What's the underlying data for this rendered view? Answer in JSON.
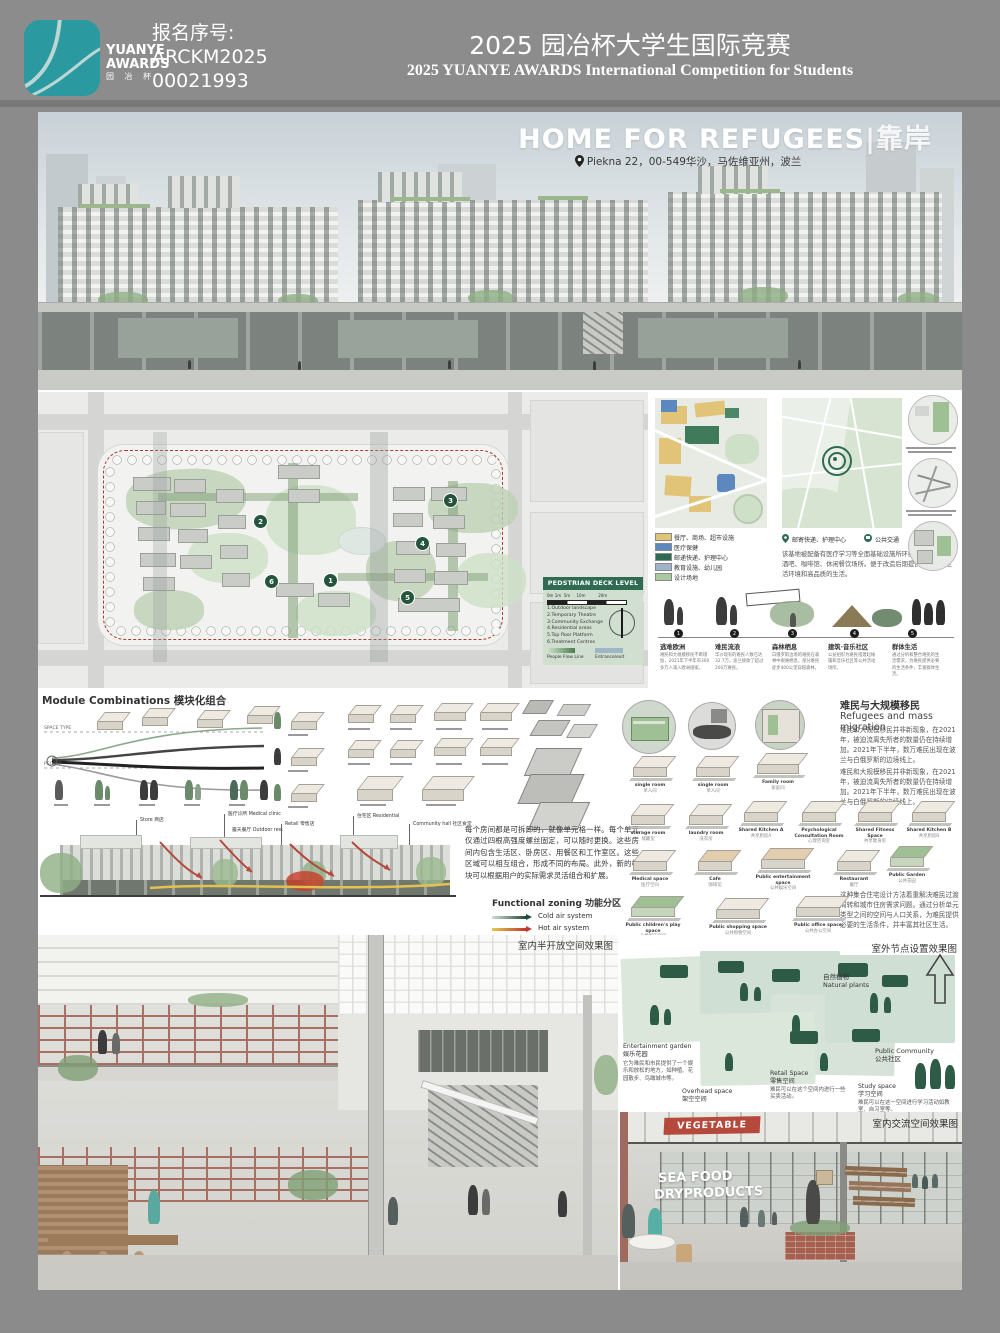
{
  "colors": {
    "brand_teal": "#2a9aa0",
    "header_gray": "#8c8c8c",
    "dark_green": "#2e6b52",
    "accent_red": "#b5493b",
    "legend1_colors": [
      "#e2c478",
      "#5d87bf",
      "#2e6b52",
      "#9fb4cc",
      "#a9c9a0"
    ]
  },
  "header": {
    "logo_line1": "YUANYE",
    "logo_line2": "AWARDS",
    "logo_line3": "园 冶 杯",
    "reg_label": "报名序号:",
    "reg_number1": "ARCKM2025",
    "reg_number2": "00021993",
    "title_zh": "2025 园冶杯大学生国际竞赛",
    "title_en": "2025 YUANYE AWARDS International Competition for  Students"
  },
  "hero": {
    "title": "HOME FOR REFUGEES",
    "title_suffix": "|靠岸",
    "location": "Piekna 22，00-549华沙，马佐维亚州，波兰"
  },
  "siteplan": {
    "legend_title": "PEDSTRIAN DECK LEVEL FLOOR",
    "scale_label": "0m 1m  5m     10m          20m",
    "items": [
      "1.Outdoor landscape",
      "2.Temporary Theatre",
      "3.Community Exchange",
      "4.Residential areas",
      "5.Top floor Platform",
      "6.Treatment Centres"
    ],
    "flow_label": "People Flow Line",
    "entrance_label": "Entrance/exit",
    "badges": [
      "1",
      "2",
      "3",
      "4",
      "5",
      "6"
    ]
  },
  "maps": {
    "legend1": [
      {
        "color": "#e2c478",
        "label": "餐厅、商场、超市设施"
      },
      {
        "color": "#5d87bf",
        "label": "医疗保健"
      },
      {
        "color": "#2e6b52",
        "label": "邮递快递、护理中心"
      },
      {
        "color": "#9fb4cc",
        "label": "教育设施、幼儿园"
      },
      {
        "color": "#a9c9a0",
        "label": "设计场地"
      }
    ],
    "legend2": [
      {
        "label": "邮寄快递、护理中心"
      },
      {
        "label": "公共交通"
      },
      {
        "label": "设计场地"
      }
    ],
    "caption": "该基地被配备有医疗学习等全面基础设施所环绕，各种餐厅、酒吧、咖啡馆、休闲餐饮场所。便于改造后期提供更优越的生活环境和高品质的生活。"
  },
  "timeline": {
    "stages": [
      {
        "num": "1",
        "title": "逃难欧洲",
        "desc": "难民和大规模移民不断增加，2021年下半年有300多万人涌入欧洲国家。"
      },
      {
        "num": "2",
        "title": "难民流浪",
        "desc": "华沙现有的难民人数已达32.7万，波兰接收了超过200万难民。"
      },
      {
        "num": "3",
        "title": "森林栖息",
        "desc": "白俄罗斯边境的难民在森林中艰难栖息，部分难民徒步400公里穿越森林。"
      },
      {
        "num": "4",
        "title": "建筑·音乐社区",
        "desc": "公益组织为难民搭建起帐篷和音乐社区等公共活动场所。"
      },
      {
        "num": "5",
        "title": "群体生活",
        "desc": "通过分析和整合难民的生活需求，为难民提供必要的生活条件，丰富群体生活。"
      }
    ]
  },
  "modules": {
    "title": "Module Combinations 模块化组合",
    "axis1": "SPACE TYPE",
    "axis2": "PEOPLE",
    "section_labels": [
      "Store 商店",
      "医疗诊所 Medical clinic",
      "露天餐厅 Outdoor rest",
      "Retail 零售店",
      "住宅区 Residential",
      "Community hall 社区食堂"
    ],
    "paragraph": "每个房间都是可拆卸的，就像单元格一样。每个单元仅通过四根高强度螺丝固定，可以随时更换。这些房间内包含生活区、卧房区、用餐区和工作室区。这些区域可以相互组合，形成不同的布局。此外，新的模块可以根据用户的实际需求灵活组合和扩展。",
    "zoning_title": "Functional zoning 功能分区",
    "zoning_cold": "Cold air system",
    "zoning_hot": "Hot air system"
  },
  "refugees": {
    "title_zh": "难民与大规模移民",
    "title_en": "Refugees and mass migration",
    "para1": "难民和大规模移民并非新现象，在2021年，被迫流离失所者的数量仍在持续增加。2021年下半年，数万难民出现在波兰与白俄罗斯的边境线上。",
    "para2": "难民和大规模移民并非新现象，在2021年，被迫流离失所者的数量仍在持续增加。2021年下半年，数万难民出现在波兰与白俄罗斯的边境线上。",
    "para3": "这种集合住宅设计方法着重解决难民过渡周转和城市住房需求问题。通过分析单元类型之间的空间与人口关系，为难民提供必要的生活条件，并丰富其社区生活。",
    "rooms": [
      {
        "en": "single room",
        "zh": "单人间"
      },
      {
        "en": "single room",
        "zh": "单人间"
      },
      {
        "en": "Family room",
        "zh": "家庭间"
      },
      {
        "en": "storage room",
        "zh": "储藏室"
      },
      {
        "en": "laundry room",
        "zh": "洗衣房"
      },
      {
        "en": "Shared Kitchen A",
        "zh": "共享厨房A"
      },
      {
        "en": "Psychological Consultation Room",
        "zh": "心理咨询室"
      },
      {
        "en": "Shared Fitness Space",
        "zh": "共享健身房"
      },
      {
        "en": "Shared Kitchen B",
        "zh": "共享厨房B"
      },
      {
        "en": "Medical space",
        "zh": "医疗空间"
      },
      {
        "en": "Cafe",
        "zh": "咖啡馆"
      },
      {
        "en": "Public entertainment space",
        "zh": "公共娱乐空间"
      },
      {
        "en": "Restaurant",
        "zh": "餐厅"
      },
      {
        "en": "Public Garden",
        "zh": "公共花园"
      },
      {
        "en": "Public children's play space",
        "zh": "儿童娱乐空间"
      },
      {
        "en": "Public shopping space",
        "zh": "公共购物空间"
      },
      {
        "en": "Public office space",
        "zh": "公共办公空间"
      }
    ]
  },
  "outdoor": {
    "label": "室外节点设置效果图",
    "natural_zh": "自然植物",
    "natural_en": "Natural plants",
    "community_en": "Public Community",
    "community_zh": "公共社区",
    "garden_en": "Entertainment garden",
    "garden_zh": "娱乐花园",
    "garden_desc": "它为难民和市民提供了一个娱乐和放松的地方，如种植、花园散步、鸟瞰城市等。",
    "overhead_en": "Overhead space",
    "overhead_zh": "架空空间",
    "retail_en": "Retail Space",
    "retail_zh": "零售空间",
    "retail_desc": "难民可以在这个空间内进行一些买卖活动。",
    "study_en": "Study space",
    "study_zh": "学习空间",
    "study_desc": "难民可以在这一空间进行学习活动如教室、自习室等。"
  },
  "renders": {
    "semi_open_label": "室内半开放空间效果图",
    "indoor_label": "室内交流空间效果图",
    "sign_vegetable": "VEGETABLE",
    "sign_seafood1": "SEA FOOD",
    "sign_seafood2": "DRYPRODUCTS"
  }
}
